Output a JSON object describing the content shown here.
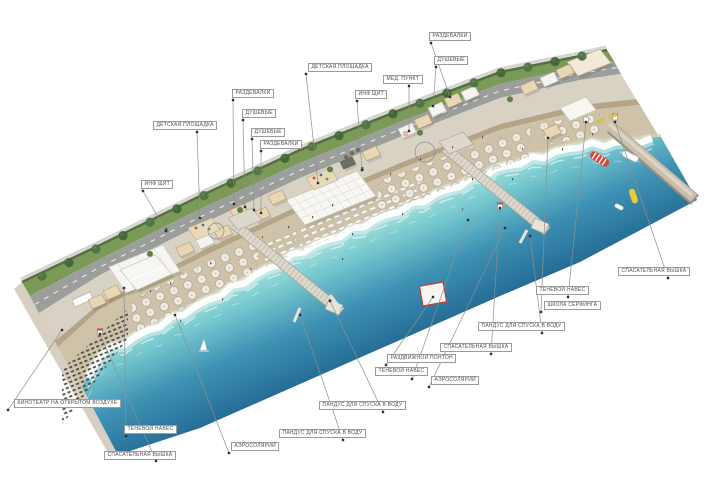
{
  "page": {
    "kind": "beach-masterplan-axonometric-rendering",
    "background": "#ffffff"
  },
  "colors": {
    "lawn": "#7c9a57",
    "hedge": "#56713f",
    "road": "#9c9e9c",
    "promenade": "#d8d2c4",
    "boardwalk": "#b5a488",
    "sand": "#cec3a9",
    "foam": "#ffffff",
    "sea_shallow": "#aadfdd",
    "sea_deep": "#1d5c86",
    "pier": "#dcd8ce",
    "leader": "#8f8f8f",
    "label_text": "#4e4e4e",
    "accent_red": "#d0392f",
    "accent_yellow": "#e3cf3b"
  },
  "labels": [
    {
      "text": "РАЗДЕВАЛКИ",
      "box": [
        429,
        32
      ],
      "dot": [
        431,
        43
      ],
      "anchor": [
        450,
        97
      ]
    },
    {
      "text": "ДУШЕВЫЕ",
      "box": [
        434,
        56
      ],
      "dot": [
        436,
        67
      ],
      "anchor": [
        433,
        106
      ]
    },
    {
      "text": "ДЕТСКАЯ ПЛОЩАДКА",
      "box": [
        308,
        63
      ],
      "dot": [
        306,
        74
      ],
      "anchor": [
        318,
        183
      ]
    },
    {
      "text": "МЕД. ПУНКТ",
      "box": [
        383,
        75
      ],
      "dot": [
        409,
        86
      ],
      "anchor": [
        409,
        131
      ]
    },
    {
      "text": "ИНФ ЩИТ",
      "box": [
        355,
        90
      ],
      "dot": [
        357,
        101
      ],
      "anchor": [
        362,
        170
      ]
    },
    {
      "text": "РАЗДЕВАЛКИ",
      "box": [
        232,
        89
      ],
      "dot": [
        233,
        100
      ],
      "anchor": [
        234,
        204
      ]
    },
    {
      "text": "ДУШЕВЫЕ",
      "box": [
        242,
        109
      ],
      "dot": [
        243,
        120
      ],
      "anchor": [
        245,
        207
      ]
    },
    {
      "text": "ДУШЕВЫЕ",
      "box": [
        251,
        128
      ],
      "dot": [
        252,
        139
      ],
      "anchor": [
        254,
        210
      ]
    },
    {
      "text": "РАЗДЕВАЛКИ",
      "box": [
        260,
        140
      ],
      "dot": [
        261,
        151
      ],
      "anchor": [
        261,
        213
      ]
    },
    {
      "text": "ДЕТСКАЯ ПЛОЩАДКА",
      "box": [
        153,
        121
      ],
      "dot": [
        197,
        132
      ],
      "anchor": [
        200,
        218
      ]
    },
    {
      "text": "ИНФ ЩИТ",
      "box": [
        141,
        180
      ],
      "dot": [
        143,
        191
      ],
      "anchor": [
        166,
        231
      ]
    },
    {
      "text": "КИНОТЕАТР НА ОТКРЫТОМ ВОЗДУХЕ",
      "box": [
        14,
        399
      ],
      "dot": [
        8,
        410
      ],
      "anchor": [
        62,
        330
      ]
    },
    {
      "text": "ТЕНЕВОЙ НАВЕС",
      "box": [
        124,
        425
      ],
      "dot": [
        126,
        436
      ],
      "anchor": [
        124,
        288
      ]
    },
    {
      "text": "СПАСАТЕЛЬНАЯ ВЫШКА",
      "box": [
        104,
        451
      ],
      "dot": [
        156,
        461
      ],
      "anchor": [
        100,
        334
      ]
    },
    {
      "text": "АЭРОСОЛЯРИЙ",
      "box": [
        231,
        442
      ],
      "dot": [
        229,
        453
      ],
      "anchor": [
        175,
        315
      ]
    },
    {
      "text": "ПАНДУС ДЛЯ СПУСКА В ВОДУ",
      "box": [
        279,
        429
      ],
      "dot": [
        343,
        440
      ],
      "anchor": [
        300,
        315
      ]
    },
    {
      "text": "ПАНДУС ДЛЯ СПУСКА В ВОДУ",
      "box": [
        319,
        401
      ],
      "dot": [
        383,
        412
      ],
      "anchor": [
        330,
        301
      ]
    },
    {
      "text": "РАЗДВИЖНОЙ ПОНТОН",
      "box": [
        387,
        354
      ],
      "dot": [
        386,
        365
      ],
      "anchor": [
        433,
        297
      ]
    },
    {
      "text": "ТЕНЕВОЙ НАВЕС",
      "box": [
        375,
        367
      ],
      "dot": [
        412,
        379
      ],
      "anchor": [
        468,
        220
      ]
    },
    {
      "text": "АЭРОСОЛЯРИЙ",
      "box": [
        431,
        376
      ],
      "dot": [
        429,
        387
      ],
      "anchor": [
        505,
        228
      ]
    },
    {
      "text": "СПАСАТЕЛЬНАЯ ВЫШКА",
      "box": [
        440,
        343
      ],
      "dot": [
        491,
        354
      ],
      "anchor": [
        500,
        208
      ]
    },
    {
      "text": "ПАНДУС ДЛЯ СПУСКА В ВОДУ",
      "box": [
        478,
        322
      ],
      "dot": [
        542,
        333
      ],
      "anchor": [
        530,
        236
      ]
    },
    {
      "text": "ШКОЛА СЕРФИНГА",
      "box": [
        544,
        301
      ],
      "dot": [
        541,
        312
      ],
      "anchor": [
        548,
        138
      ]
    },
    {
      "text": "ТЕНЕВОЙ НАВЕС",
      "box": [
        536,
        286
      ],
      "dot": [
        568,
        297
      ],
      "anchor": [
        586,
        122
      ]
    },
    {
      "text": "СПАСАТЕЛЬНАЯ ВЫШКА",
      "box": [
        618,
        267
      ],
      "dot": [
        668,
        278
      ],
      "anchor": [
        615,
        122
      ]
    }
  ],
  "callout_circles": [
    [
      425,
      152,
      10
    ],
    [
      216,
      231,
      8
    ]
  ],
  "sea_objects": [
    {
      "name": "sailboat",
      "x": 204,
      "y": 346
    },
    {
      "name": "kitesurf-kite-red-striped",
      "x": 598,
      "y": 158
    },
    {
      "name": "kite-white",
      "x": 631,
      "y": 156
    },
    {
      "name": "kite-yellow",
      "x": 637,
      "y": 196
    },
    {
      "name": "dinghy-white",
      "x": 621,
      "y": 206
    },
    {
      "name": "pontoon-red-frame",
      "x": 433,
      "y": 294
    }
  ]
}
